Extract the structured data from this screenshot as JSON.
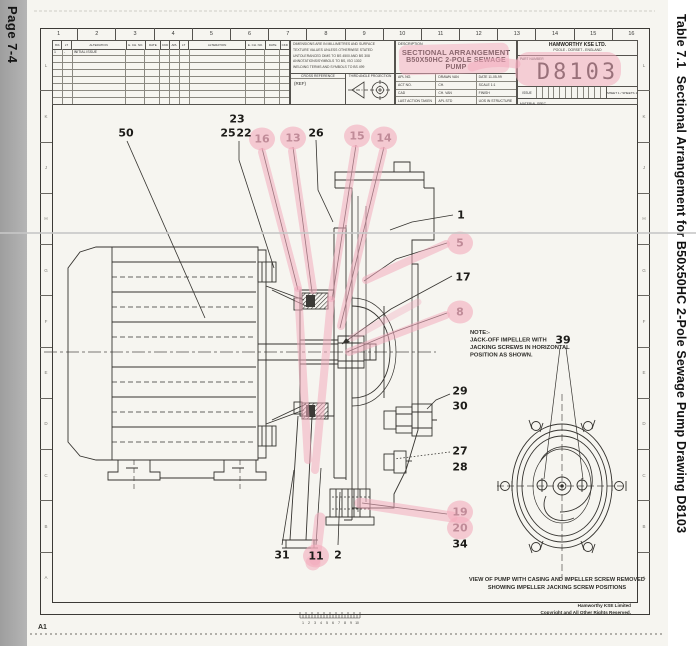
{
  "page": {
    "left_margin_label": "Page 7-4",
    "right_margin_label": "Table 7.1  Sectional Arrangement for B50x50HC 2-Pole Sewage Pump Drawing D8103",
    "corner_ref": "A1",
    "highlight_color": "#f3acbd"
  },
  "grid": {
    "top_numbers": [
      "1",
      "2",
      "3",
      "4",
      "5",
      "6",
      "7",
      "8",
      "9",
      "10",
      "11",
      "12",
      "13",
      "14",
      "15",
      "16"
    ],
    "side_letters": [
      "L",
      "K",
      "J",
      "H",
      "G",
      "F",
      "E",
      "D",
      "C",
      "B",
      "A"
    ]
  },
  "revision_table": {
    "headers": [
      "ISS",
      "LT",
      "ALTERATION",
      "E. CH. NO.",
      "DATE",
      "CKD",
      "APL",
      "LT",
      "ALTERATION",
      "E. CH. NO.",
      "DATE",
      "CKD"
    ],
    "row1": [
      "1",
      "-",
      "INITIAL ISSUE"
    ]
  },
  "notes_block": {
    "lines": [
      "DIMENSIONS ARE IN MILLIMETRES AND SURFACE",
      "TEXTURE VALUES UNLESS OTHERWISE STATED",
      "UNTOLERANCED DIMS TO BS 4500 AND BS 308",
      "ANNOTATIONS/SYMBOLS TO BS, ISO 1302",
      "WELDING TERMS AND SYMBOLS TO BS 499"
    ],
    "cross_reference_label": "CROSS REFERENCE",
    "cross_reference_value": "(REF)",
    "projection_label": "THIRD ANGLE PROJECTION"
  },
  "title_block": {
    "description_label": "DESCRIPTION",
    "title_line1": "SECTIONAL ARRANGEMENT",
    "title_line2": "B50X50HC 2-POLE SEWAGE PUMP",
    "fields": [
      [
        "APL NO.",
        "DRAWN  VAN",
        "DATE  11-05-99"
      ],
      [
        "ACT NO.",
        "CH.",
        "SCALE  1:1"
      ],
      [
        "CAD",
        "CH.  VAN",
        "FINISH"
      ],
      [
        "LAST ACTION TAKEN",
        "APL  STD",
        "UOS IN STRUCTURE"
      ]
    ],
    "company_line1": "HAMWORTHY KSE LTD.",
    "company_line2": "POOLE  -  DORSET  -  ENGLAND",
    "part_number_label": "PART NUMBER",
    "part_number": "D8103",
    "issue_label": "ISSUE",
    "sheet_label": "SHEET 1 / SHEETS 1",
    "material_label": "MATERIAL SPEC."
  },
  "drawing": {
    "note_lines": [
      "NOTE:-",
      "JACK-OFF IMPELLER WITH",
      "JACKING SCREWS IN HORIZONTAL",
      "POSITION AS SHOWN."
    ],
    "caption_line1": "VIEW OF PUMP WITH CASING AND IMPELLER SCREW REMOVED",
    "caption_line2": "SHOWING IMPELLER JACKING SCREW POSITIONS",
    "footer_line1": "Hamworthy KSE Limited",
    "footer_line2": "Copyright and All Other Rights Reserved.",
    "scale_numbers": [
      "1",
      "2",
      "3",
      "4",
      "5",
      "6",
      "7",
      "8",
      "9",
      "10"
    ],
    "callouts": [
      {
        "n": "50",
        "x": 126,
        "y": 133,
        "hl": false,
        "fade": false
      },
      {
        "n": "23",
        "x": 237,
        "y": 119,
        "hl": false,
        "fade": false
      },
      {
        "n": "25",
        "x": 228,
        "y": 133,
        "hl": false,
        "fade": false
      },
      {
        "n": "22",
        "x": 244,
        "y": 133,
        "hl": false,
        "fade": false
      },
      {
        "n": "16",
        "x": 262,
        "y": 139,
        "hl": true,
        "fade": true
      },
      {
        "n": "13",
        "x": 293,
        "y": 138,
        "hl": true,
        "fade": true
      },
      {
        "n": "26",
        "x": 316,
        "y": 133,
        "hl": false,
        "fade": false
      },
      {
        "n": "15",
        "x": 357,
        "y": 136,
        "hl": true,
        "fade": true
      },
      {
        "n": "14",
        "x": 384,
        "y": 138,
        "hl": true,
        "fade": true
      },
      {
        "n": "1",
        "x": 461,
        "y": 215,
        "hl": false,
        "fade": false
      },
      {
        "n": "5",
        "x": 460,
        "y": 243,
        "hl": true,
        "fade": true
      },
      {
        "n": "17",
        "x": 463,
        "y": 277,
        "hl": false,
        "fade": false
      },
      {
        "n": "8",
        "x": 460,
        "y": 312,
        "hl": true,
        "fade": true
      },
      {
        "n": "29",
        "x": 460,
        "y": 391,
        "hl": false,
        "fade": false
      },
      {
        "n": "30",
        "x": 460,
        "y": 406,
        "hl": false,
        "fade": false
      },
      {
        "n": "27",
        "x": 460,
        "y": 451,
        "hl": false,
        "fade": false
      },
      {
        "n": "28",
        "x": 460,
        "y": 467,
        "hl": false,
        "fade": false
      },
      {
        "n": "19",
        "x": 460,
        "y": 512,
        "hl": true,
        "fade": true
      },
      {
        "n": "20",
        "x": 460,
        "y": 528,
        "hl": true,
        "fade": true
      },
      {
        "n": "34",
        "x": 460,
        "y": 544,
        "hl": false,
        "fade": false
      },
      {
        "n": "31",
        "x": 282,
        "y": 555,
        "hl": false,
        "fade": false
      },
      {
        "n": "11",
        "x": 316,
        "y": 556,
        "hl": true,
        "fade": false
      },
      {
        "n": "2",
        "x": 338,
        "y": 555,
        "hl": false,
        "fade": false
      },
      {
        "n": "39",
        "x": 563,
        "y": 340,
        "hl": false,
        "fade": false
      }
    ]
  }
}
